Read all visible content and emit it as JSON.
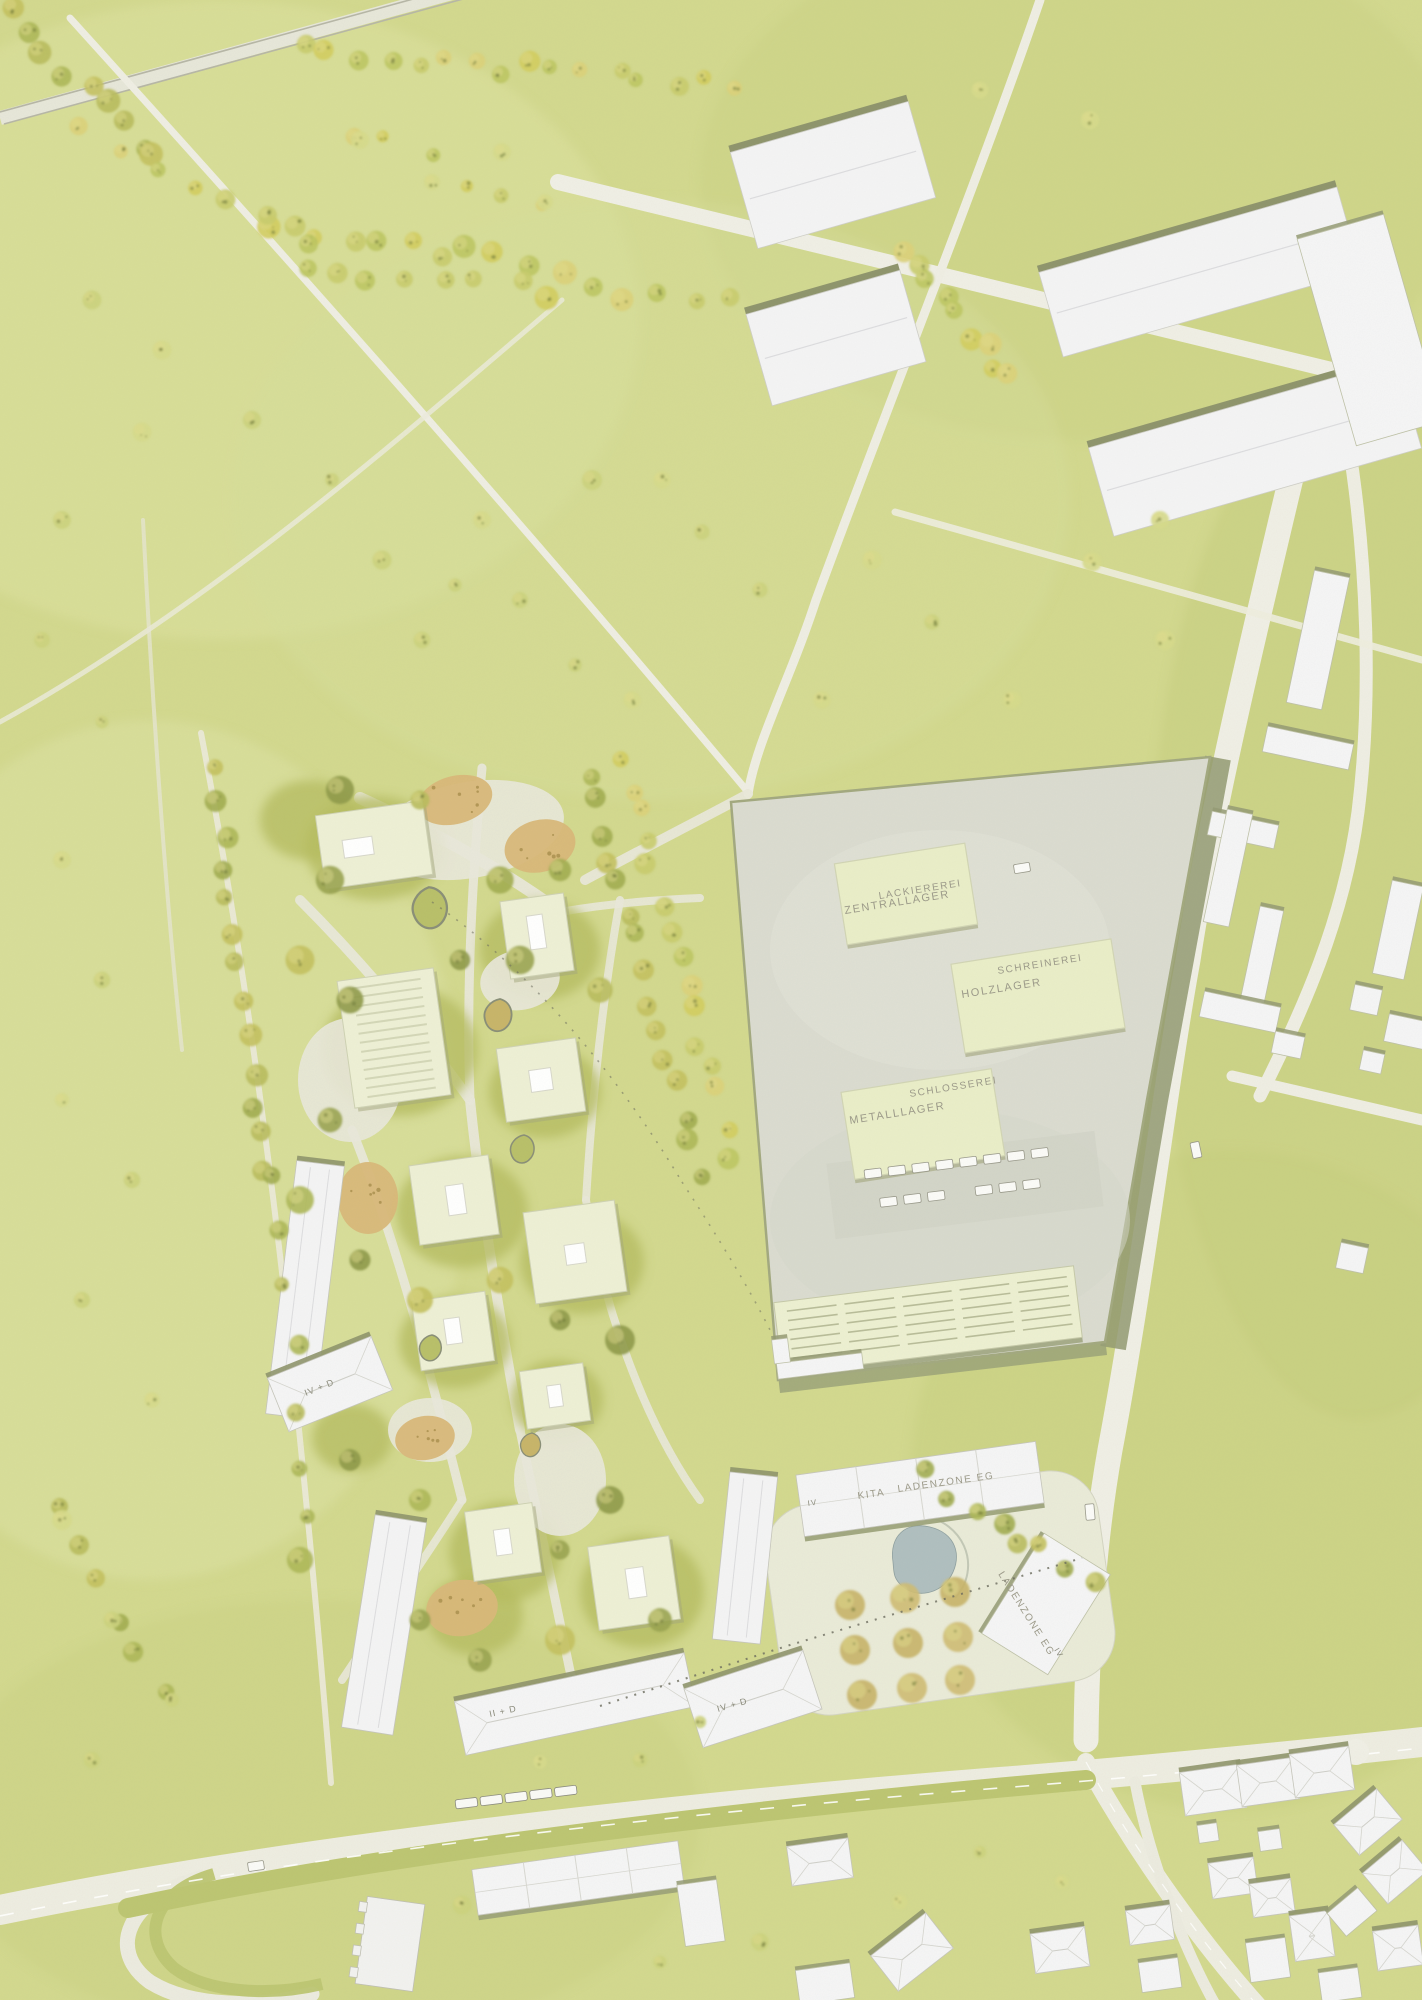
{
  "plan": {
    "kind": "architectural competition site plan, aerial axonometric rendering",
    "labels": {
      "lackiererei": "LACKIEREREI",
      "zentrallager": "ZENTRALLAGER",
      "schreinerei": "SCHREINEREI",
      "holzlager": "HOLZLAGER",
      "schlosserei": "SCHLOSSEREI",
      "metalllager": "METALLLAGER",
      "kita": "KITA",
      "ladenzone_eg": "LADENZONE EG",
      "ladenzone_eg_vertical": "LADENZONE EG",
      "storeys_left": "IV + D",
      "storeys_mid": "II + D",
      "storeys_south": "IV + D",
      "storeys_kita": "IV",
      "storeys_laden": "IV"
    },
    "colors": {
      "grass": "#d3d98f",
      "road": "#efeee4",
      "tram_corridor": "#bdc673",
      "plaza_concrete": "#dbdcd1",
      "plaza_shadow_olive": "#939a72",
      "roof_white": "#f4f4f5",
      "roof_cream": "#eef0d6",
      "roof_workshop": "#eaeec9",
      "wall_olive": "#8f956d",
      "tree_green": "#b9bd5e",
      "tree_yellow": "#d3cd60",
      "playground_tan": "#d9b87a",
      "pond_blue": "#b0bfc0",
      "label_grey": "#9c9a8a"
    }
  }
}
